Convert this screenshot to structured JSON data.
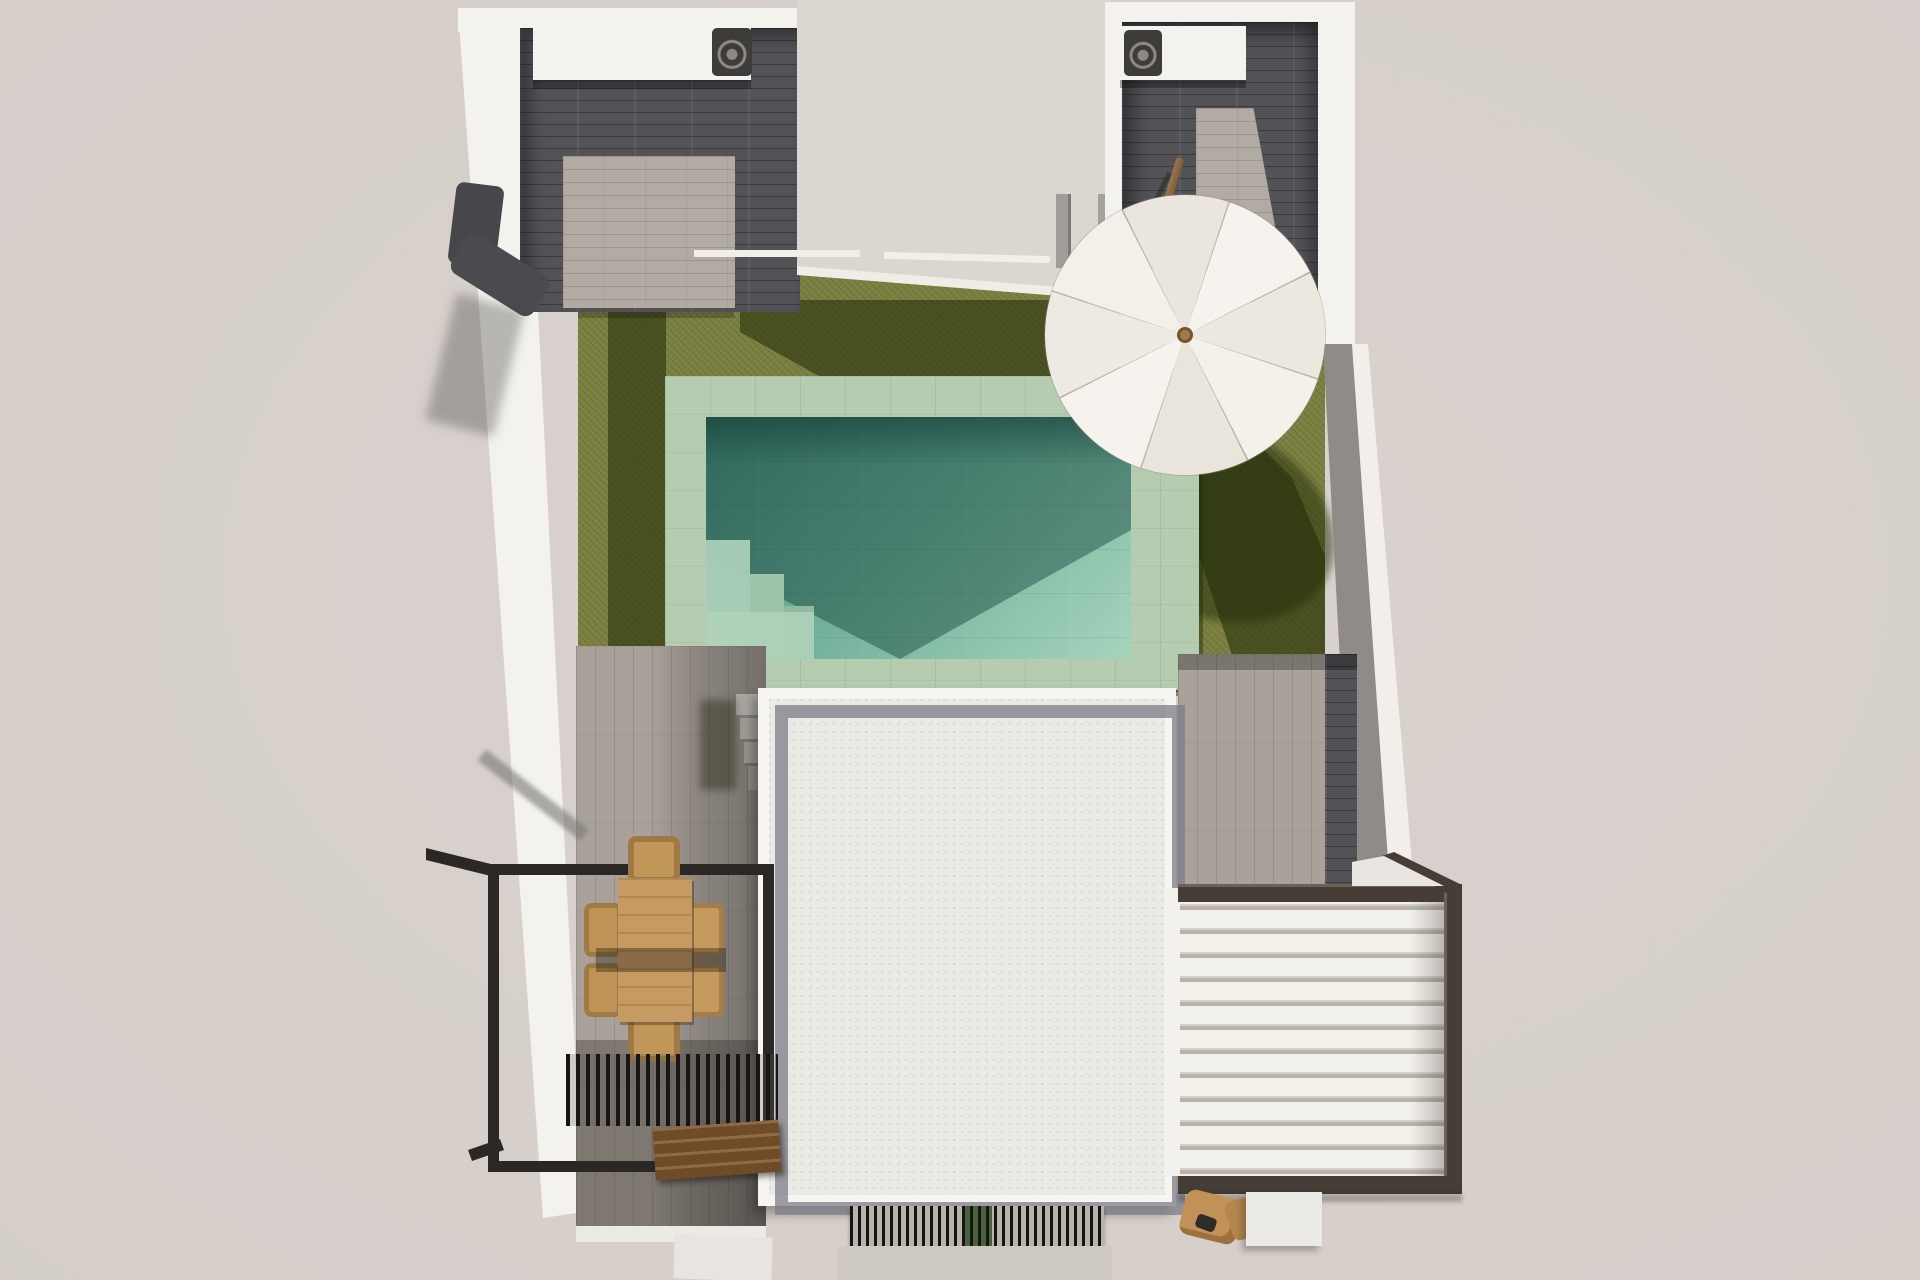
{
  "scene": {
    "type": "architectural-3d-render",
    "view": "top-down aerial view",
    "subject": "Detached villa plot with private pool, lawn, roof terrace and pergolas",
    "ground": {
      "label": "site background",
      "color": "#d6cfca"
    },
    "building": {
      "walls_color": "#f4f2ee",
      "left_courtyard": {
        "floor_dark": "#525257",
        "floor_light": "#b2aba3",
        "ac_unit": "white block with fan grille"
      },
      "right_courtyard": {
        "floor_dark": "#505055",
        "floor_light": "#b2aba3",
        "ac_unit": "white block with fan grille",
        "umbrella_pole": "#8a6a44"
      },
      "middle_roof": {
        "color": "#dcd6d1",
        "chimneys": 2,
        "ledge_color": "#f0ede9"
      }
    },
    "garden": {
      "lawn_color": "#7b8040",
      "lawn_shadow_color": "#45511f",
      "pool": {
        "coping_color": "#b6ccb0",
        "water_light": "#a6d4bd",
        "water_mid": "#6fae98",
        "water_dark": "#3f7b6e",
        "steps": "corner steps bottom-left"
      },
      "umbrella": {
        "canopy_color": "#f4f1ec",
        "gores": 8,
        "hub_color": "#a3794a"
      }
    },
    "terraces": {
      "left_terrace": {
        "tile_color": "#a9a29a",
        "railing_frame_color": "#2a2725",
        "dining_table_color": "#c69a63",
        "chairs": 6,
        "chair_color": "#c09659",
        "grill_slats_color": "#171615",
        "bench_color": "#6f4b28"
      },
      "main_roof": {
        "gravel_color": "#eceae5",
        "parapet_band_color": "#9b99a0",
        "rim_color": "#f7f5f2"
      },
      "right_pergola": {
        "louvre_color": "#f2f0eb",
        "louvre_count": 12,
        "frame_color": "#453d36",
        "stool_color": "#c29158",
        "step_color": "#eceae6"
      },
      "drain_grate": {
        "slat_color": "#161514",
        "planter_color": "#49613c"
      }
    }
  }
}
